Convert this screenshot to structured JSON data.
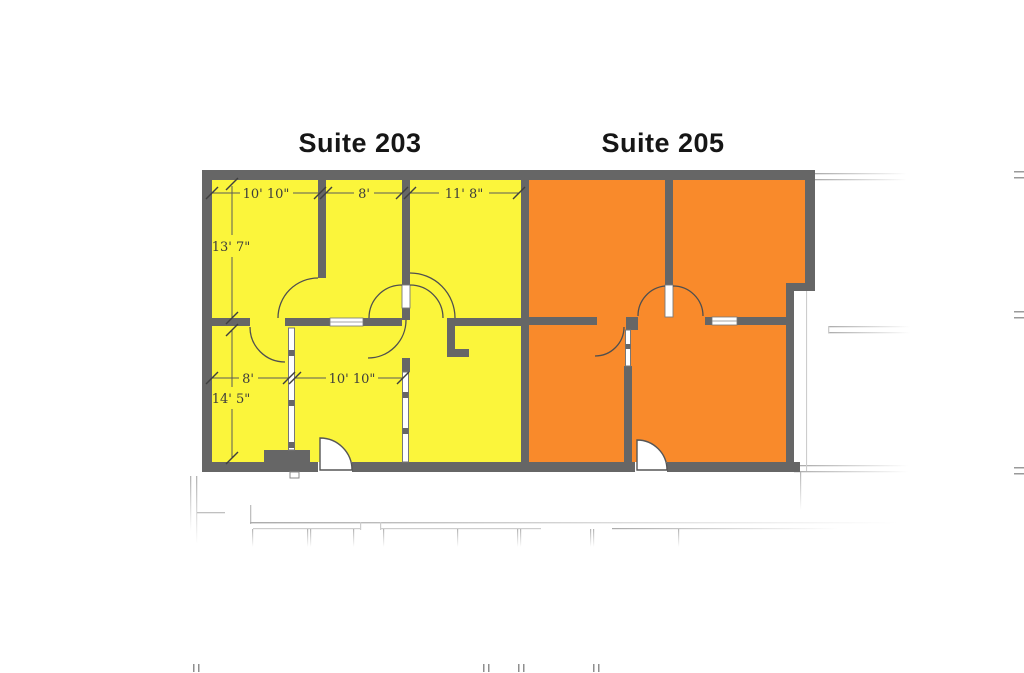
{
  "floor_plan": {
    "suite_203": {
      "title": "Suite 203",
      "fill_color": "#FBF53B",
      "dims": {
        "top_room1_width": "10' 10\"",
        "top_room2_width": "8'",
        "top_room3_width": "11' 8\"",
        "left_room_depth": "13' 7\"",
        "lower_left_room_width": "8'",
        "lower_middle_room_width": "10' 10\"",
        "lower_room_depth": "14' 5\""
      }
    },
    "suite_205": {
      "title": "Suite 205",
      "fill_color": "#F98A2B"
    },
    "colors": {
      "wall": "#666666",
      "dimension_text": "#3c3c3c",
      "title_text": "#161616",
      "faint_lines": "#c0c0c0",
      "door_fill": "#ffffff"
    }
  }
}
